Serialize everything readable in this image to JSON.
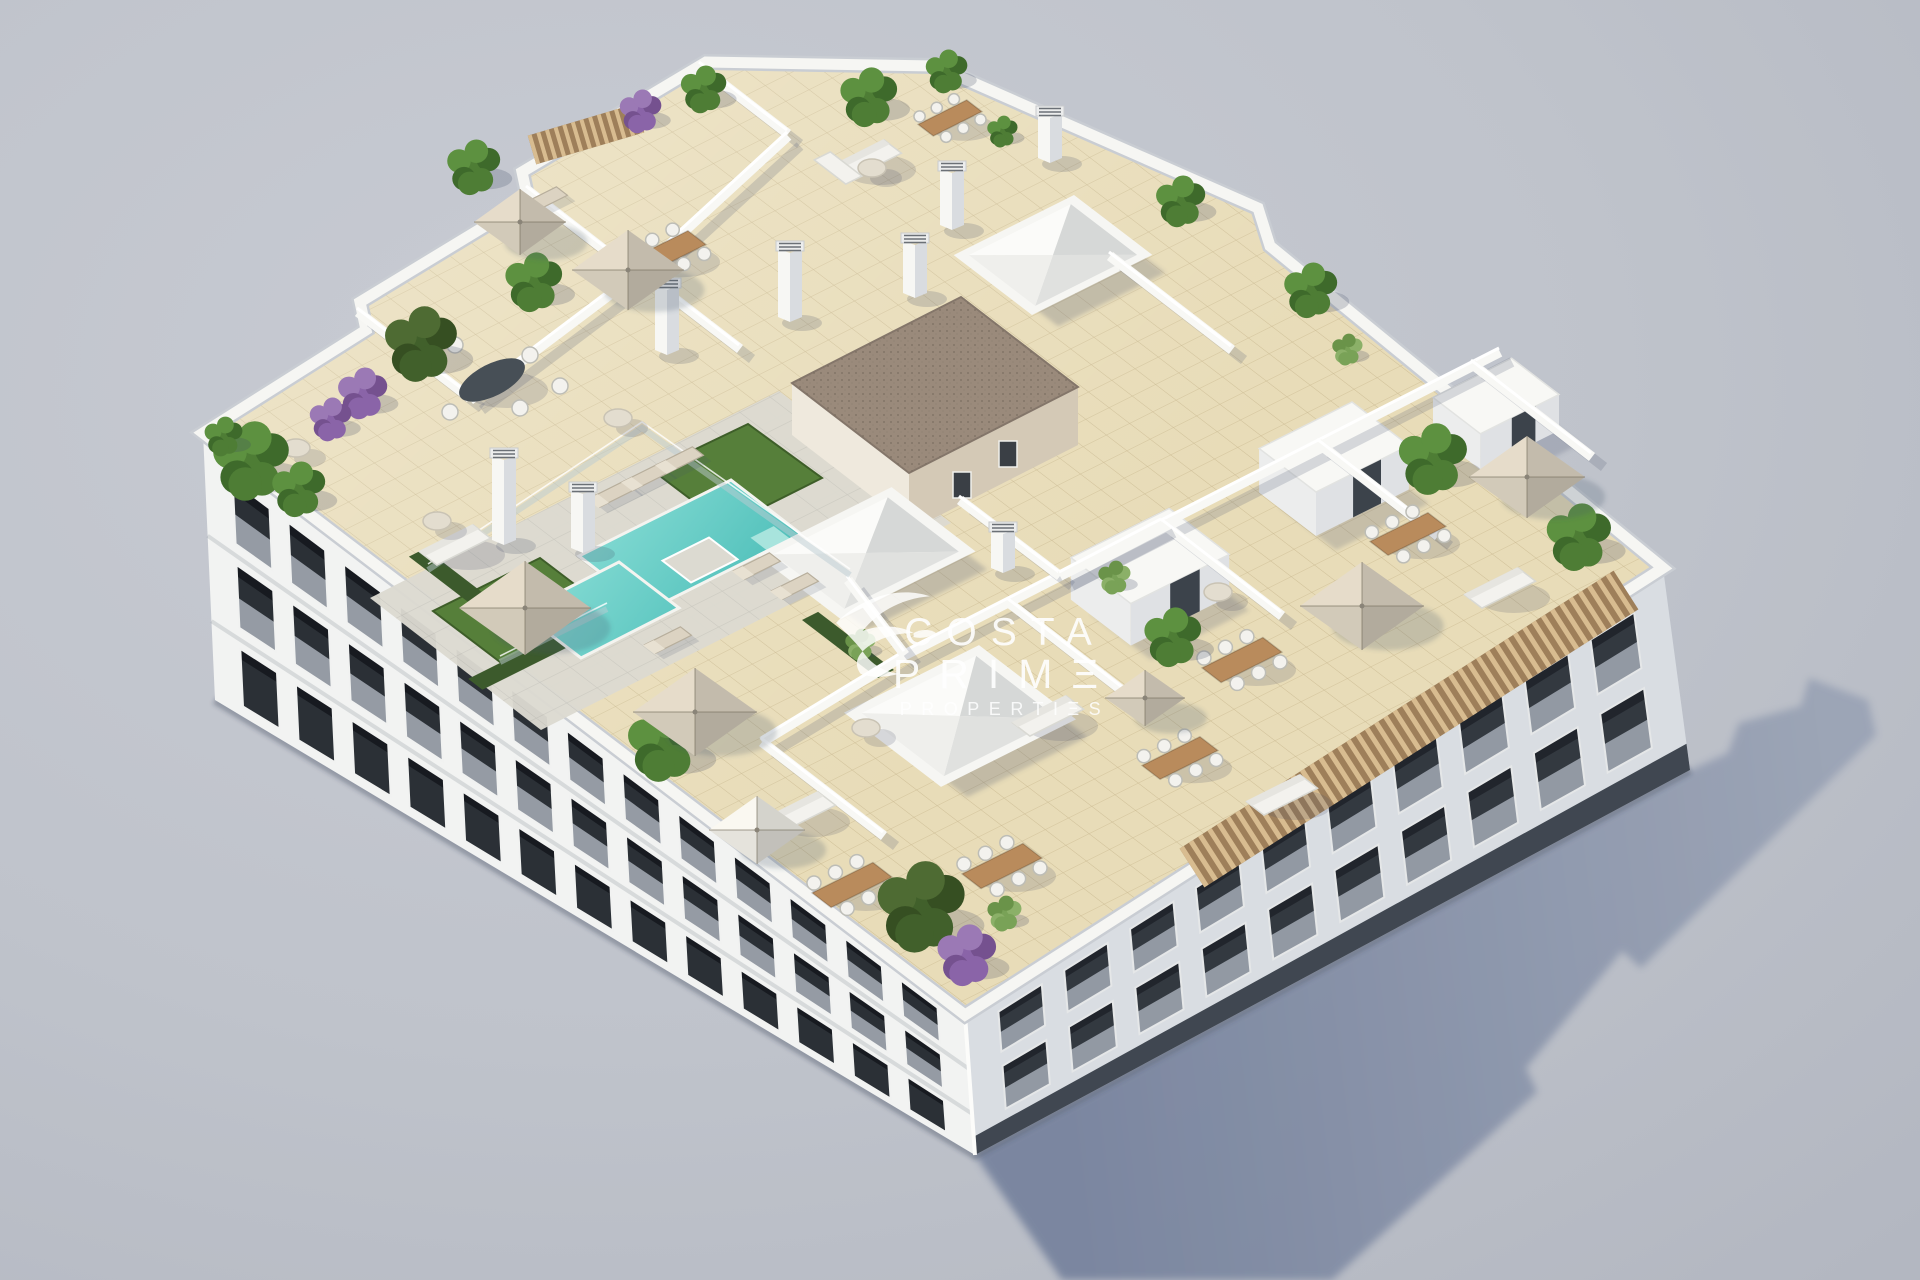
{
  "scene": {
    "type": "3d-architectural-render",
    "subject": "aerial isometric view of a white apartment building rooftop with swimming pool, penthouse terraces, plants and parasols",
    "background": "plain gray studio backdrop",
    "shadow_direction": "lower-right"
  },
  "watermark": {
    "brand": "Costa Prime Properties",
    "line1": "COSTA",
    "line2": "PRIMΞ",
    "line3": "PROPERTIΞS",
    "logo": "swallow-bird-icon"
  },
  "colors": {
    "background": "#bfc3cb",
    "background_top": "#c8cbd3",
    "shadow_near": "#76829d",
    "shadow_far": "#9aa3b5",
    "building_white": "#f2f3f2",
    "facade_se": "#e4e7ea",
    "window_dark": "#2b3036",
    "plinth": "#394049",
    "parapet_white": "#f6f6f3",
    "roof_tile": "#e8dcb8",
    "tile_line": "#b49f74",
    "deck": "#dcdad1",
    "deck_line": "#bdbbb2",
    "pool_light": "#8ee0d8",
    "pool_deep": "#3db6b1",
    "grass": "#567f3a",
    "hedge": "#3c5a2c",
    "gravel": "#9a8a7b",
    "core_tan": "#d4c9b6",
    "wood": "#b98b5c",
    "pergola": "#d8bc90",
    "pergola_dark": "#9e7f5a",
    "umbrella_tan": "#d9d0bf",
    "umbrella_white": "#eceae3",
    "white_furniture": "#f3f2ee",
    "plant_green": "#4e7d35",
    "plant_dark": "#41602b",
    "plant_purple": "#8a64a8",
    "watermark": "#ffffff"
  }
}
